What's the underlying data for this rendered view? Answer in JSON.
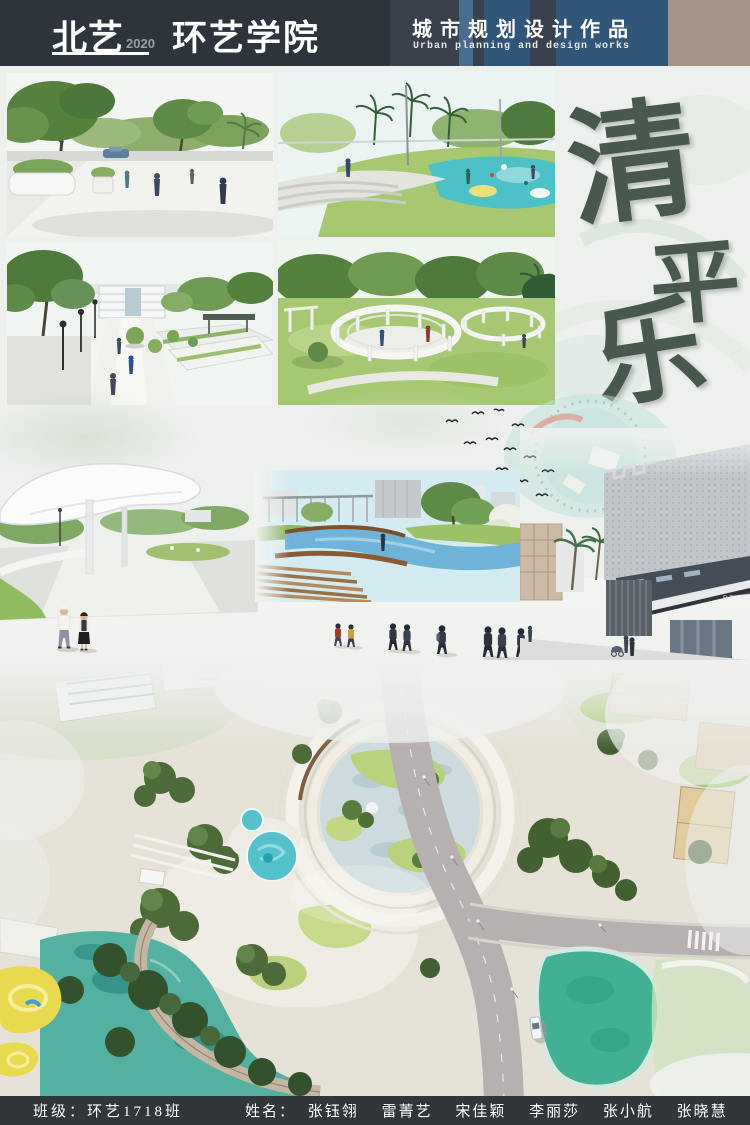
{
  "header": {
    "brand": "北艺",
    "brand_year": "2020",
    "college": "环艺学院",
    "title_zh": "城市规划设计作品",
    "title_en": "Urban planning and design works"
  },
  "calligraphy": {
    "full": "清平乐",
    "char1": "清",
    "char2": "平",
    "char3": "乐"
  },
  "scenes": {
    "retail_sign": "RETAIL"
  },
  "footer": {
    "class_label": "班级：",
    "class_value": "环艺1718班",
    "names_label": "姓名：",
    "names": [
      "张钰翎",
      "雷菁艺",
      "宋佳颖",
      "李丽莎",
      "张小航",
      "张晓慧"
    ]
  },
  "colors": {
    "header_dark": "#2d343c",
    "header_panel_blue": "#30567a",
    "header_stripe_blue": "#4a6d8e",
    "header_tan": "#a39488",
    "calligraphy_green": "#3c4c42",
    "footer_dark": "#31363a",
    "lagoon_teal": "#54b0a0",
    "pond_green": "#42b092",
    "lawn_green": "#a6c873"
  }
}
